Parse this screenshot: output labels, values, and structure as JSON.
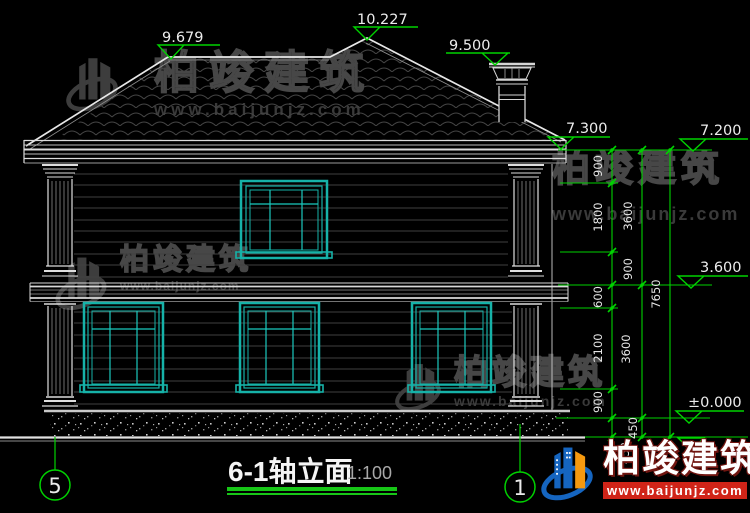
{
  "drawing": {
    "title": "6-1轴立面",
    "scale": "1:100",
    "axes": {
      "left": "5",
      "right": "1"
    },
    "elevations": {
      "ridge": "9.679",
      "peak": "10.227",
      "chimney": "9.500",
      "eave_edge": "7.300",
      "eave": "7.200",
      "floor2": "3.600",
      "ground": "±0.000"
    },
    "dims": {
      "detail": [
        "900",
        "1800",
        "900",
        "600",
        "2100",
        "900",
        "450"
      ],
      "floors": [
        "3600",
        "3600",
        "450"
      ],
      "total": [
        "7650"
      ]
    },
    "colors": {
      "dim_green": "#00d200",
      "window_teal": "#16b2a8",
      "line_white": "#e8e8e8",
      "underline_green": "#17c617",
      "logo_blue": "#1565c0",
      "logo_orange": "#f5990f",
      "logo_red": "#d02418"
    }
  },
  "watermark": {
    "brand": "柏竣建筑",
    "url": "www.baijunjz.com"
  },
  "footer": {
    "brand": "柏竣建筑",
    "url": "www.baijunjz.com"
  }
}
